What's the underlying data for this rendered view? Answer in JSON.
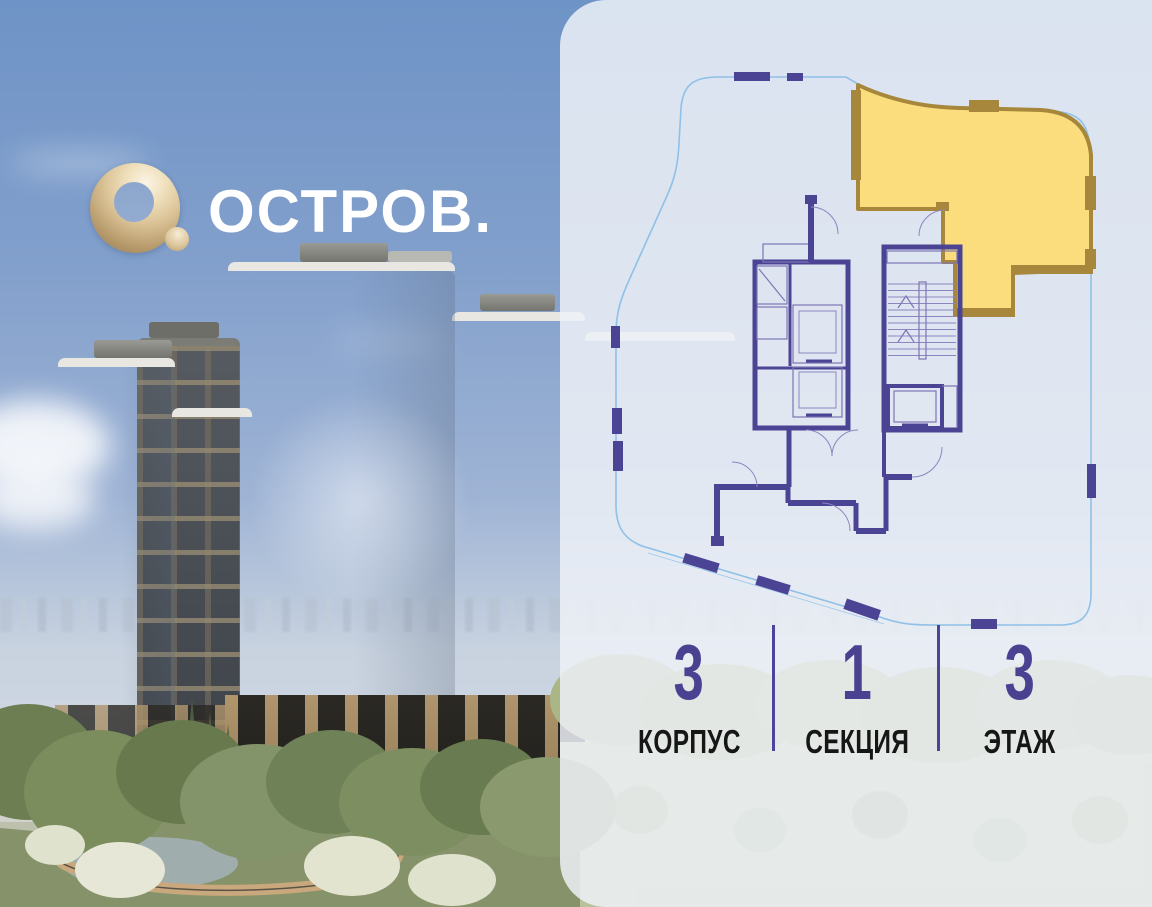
{
  "brand": {
    "logo_icon": "gold-ring-logo",
    "name": "ОСТРОВ."
  },
  "floorplan_card": {
    "selected_unit": "corner-apartment-top-right",
    "stats": [
      {
        "value": "3",
        "label": "КОРПУС"
      },
      {
        "value": "1",
        "label": "СЕКЦИЯ"
      },
      {
        "value": "3",
        "label": "ЭТАЖ"
      }
    ]
  },
  "colors": {
    "accent-purple": "#4B4394",
    "outline-blue": "#8FC0E8",
    "unit-yellow": "#FBDD7D",
    "unit-gold": "#A6873B",
    "stat-number": "#4A4191",
    "stat-label": "#161616",
    "divider-purple": "#4C449B",
    "panel-tint": "#EDF1F7",
    "logo-gold": "#DCC498",
    "brand-white": "#FFFFFF",
    "sky-top": "#6E93C6",
    "sky-bottom": "#C9D3E0"
  }
}
